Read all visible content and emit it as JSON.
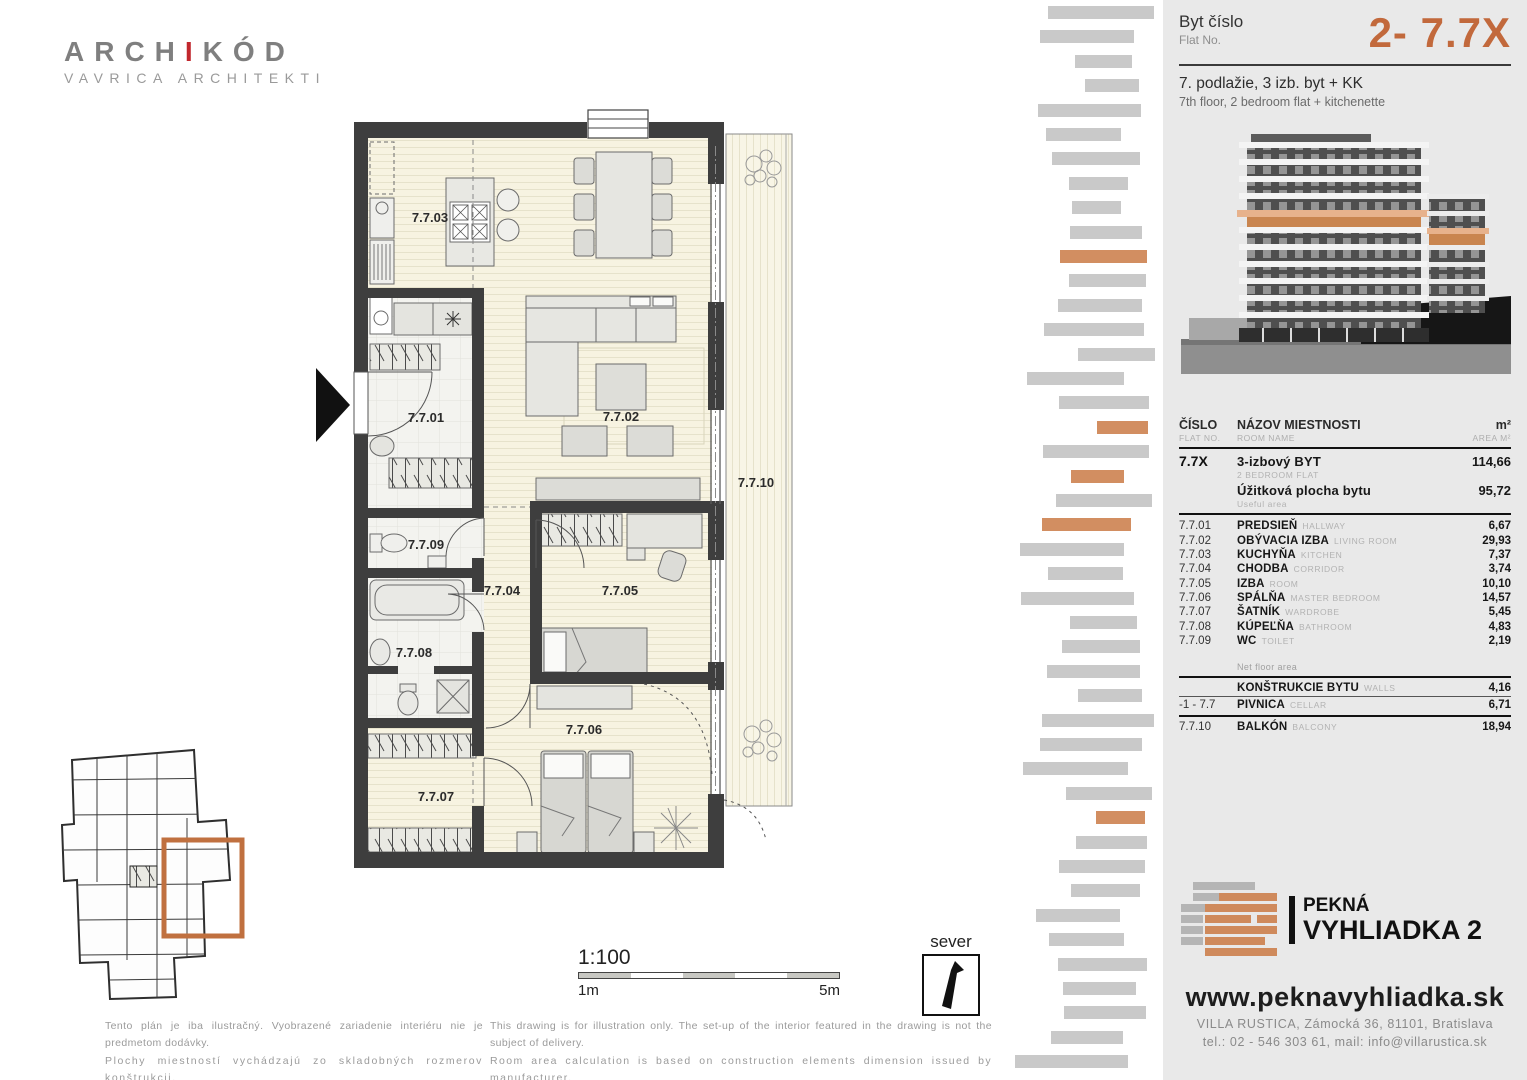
{
  "brand_logo": {
    "part1": "ARCH",
    "accent": "I",
    "part2": "KÓD",
    "subtitle": "VAVRICA ARCHITEKTI"
  },
  "flat_header": {
    "label_sk": "Byt číslo",
    "label_en": "Flat No.",
    "number": "2- 7.7X",
    "desc_sk": "7. podlažie, 3 izb. byt + KK",
    "desc_en": "7th floor, 2 bedroom flat + kitchenette"
  },
  "area_table": {
    "header": {
      "num_sk": "ČÍSLO",
      "num_en": "FLAT NO.",
      "name_sk": "NÁZOV MIESTNOSTI",
      "name_en": "ROOM NAME",
      "area_sk": "m²",
      "area_en": "AREA M²"
    },
    "summary": {
      "num": "7.7X",
      "name": "3-izbový BYT",
      "name_en": "2 BEDROOM FLAT",
      "area": "114,66",
      "useful_label": "Úžitková plocha bytu",
      "useful_label_en": "Useful area",
      "useful_area": "95,72"
    },
    "rooms": [
      {
        "num": "7.7.01",
        "name": "PREDSIEŇ",
        "name_en": "HALLWAY",
        "area": "6,67"
      },
      {
        "num": "7.7.02",
        "name": "OBÝVACIA IZBA",
        "name_en": "LIVING ROOM",
        "area": "29,93"
      },
      {
        "num": "7.7.03",
        "name": "KUCHYŇA",
        "name_en": "KITCHEN",
        "area": "7,37"
      },
      {
        "num": "7.7.04",
        "name": "CHODBA",
        "name_en": "CORRIDOR",
        "area": "3,74"
      },
      {
        "num": "7.7.05",
        "name": "IZBA",
        "name_en": "ROOM",
        "area": "10,10"
      },
      {
        "num": "7.7.06",
        "name": "SPÁLŇA",
        "name_en": "MASTER BEDROOM",
        "area": "14,57"
      },
      {
        "num": "7.7.07",
        "name": "ŠATNÍK",
        "name_en": "WARDROBE",
        "area": "5,45"
      },
      {
        "num": "7.7.08",
        "name": "KÚPEĽŇA",
        "name_en": "BATHROOM",
        "area": "4,83"
      },
      {
        "num": "7.7.09",
        "name": "WC",
        "name_en": "TOILET",
        "area": "2,19"
      }
    ],
    "net_label": "Net floor area",
    "extras": [
      {
        "num": "",
        "name": "KONŠTRUKCIE BYTU",
        "name_en": "WALLS",
        "area": "4,16"
      },
      {
        "num": "-1 - 7.7",
        "name": "PIVNICA",
        "name_en": "CELLAR",
        "area": "6,71"
      },
      {
        "num": "7.7.10",
        "name": "BALKÓN",
        "name_en": "BALCONY",
        "area": "18,94"
      }
    ]
  },
  "plan": {
    "room_ids": [
      "7.7.01",
      "7.7.02",
      "7.7.03",
      "7.7.04",
      "7.7.05",
      "7.7.06",
      "7.7.07",
      "7.7.08",
      "7.7.09",
      "7.7.10"
    ],
    "scale_label": "1:100",
    "scale_start": "1m",
    "scale_end": "5m",
    "north_label": "sever"
  },
  "disclaimer": {
    "sk1": "Tento plán je iba ilustračný. Vyobrazené zariadenie interiéru nie je predmetom dodávky.",
    "sk2": "Plochy miestností vychádzajú zo skladobných rozmerov konštrukcii.",
    "en1": "This drawing is for illustration only. The set-up of the interior featured in the drawing is not the subject of delivery.",
    "en2": "Room area calculation is based on construction elements dimension issued by manufacturer."
  },
  "project": {
    "name_line1": "PEKNÁ",
    "name_line2": "VYHLIADKA 2",
    "website": "www.peknavyhliadka.sk",
    "address": "VILLA RUSTICA, Zámocká 36, 81101, Bratislava",
    "contact": "tel.: 02 - 546 303 61, mail: info@villarustica.sk"
  },
  "colors": {
    "accent_orange": "#c2693c",
    "bar_gray": "#c9c9c9",
    "bar_orange": "#d28e61",
    "panel_bg": "#e9e9e9",
    "wall": "#3e3e3e"
  }
}
